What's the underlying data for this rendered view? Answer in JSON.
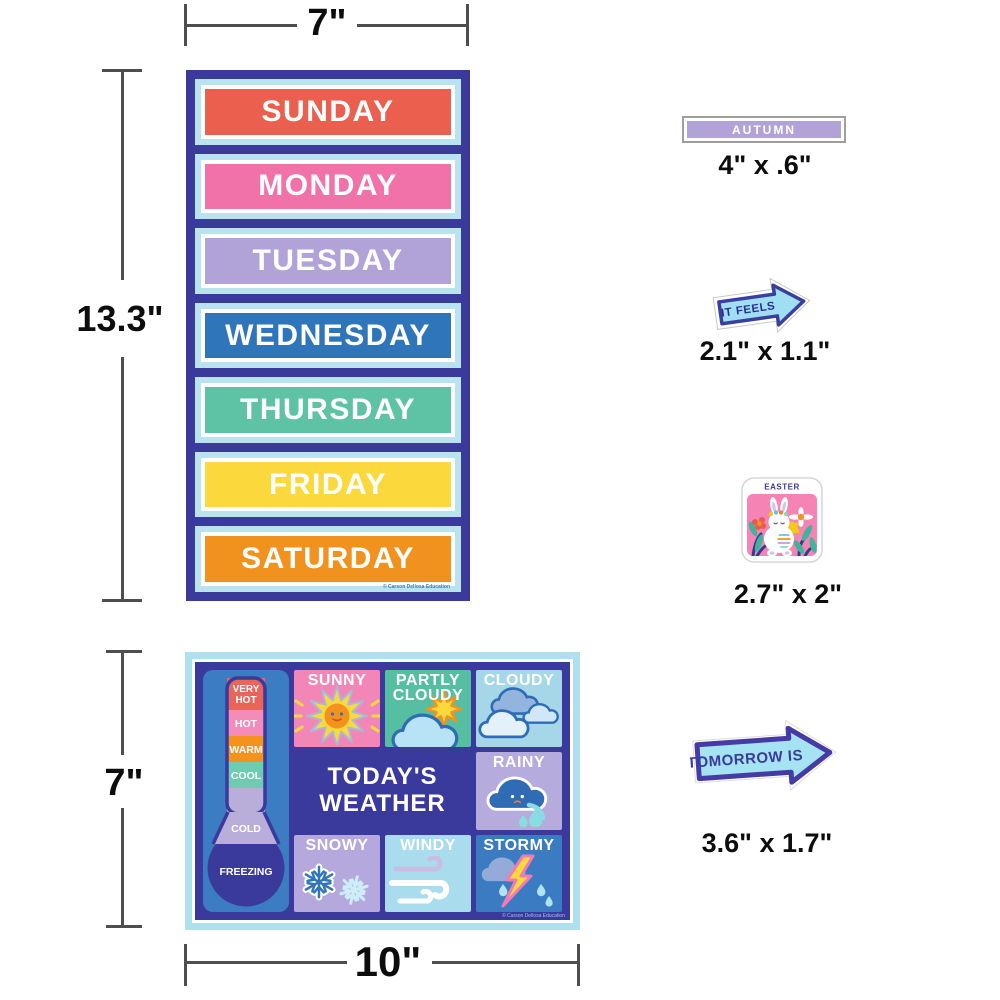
{
  "palette": {
    "navy": "#3a3a9c",
    "light_cyan": "#b9e4ef",
    "column_blue": "#3c7cc2",
    "dimension_line": "#4e4e4e"
  },
  "dimensions": {
    "days_width": "7\"",
    "days_height": "13.3\"",
    "weather_height": "7\"",
    "weather_width": "10\"",
    "autumn_size": "4\" x .6\"",
    "it_feels_size": "2.1\" x 1.1\"",
    "easter_size": "2.7\" x 2\"",
    "tomorrow_size": "3.6\" x 1.7\""
  },
  "days_chart": {
    "days": [
      {
        "label": "SUNDAY",
        "color": "#ea5f4e"
      },
      {
        "label": "MONDAY",
        "color": "#f172a9"
      },
      {
        "label": "TUESDAY",
        "color": "#b1a3d8"
      },
      {
        "label": "WEDNESDAY",
        "color": "#2f75ba"
      },
      {
        "label": "THURSDAY",
        "color": "#5ec3a4"
      },
      {
        "label": "FRIDAY",
        "color": "#fbd93d"
      },
      {
        "label": "SATURDAY",
        "color": "#f1911e"
      }
    ],
    "copyright": "© Carson Dellosa Education"
  },
  "weather_chart": {
    "title": "TODAY'S WEATHER",
    "title_lines": [
      "TODAY'S",
      "WEATHER"
    ],
    "thermometer": {
      "segments": [
        {
          "label": "VERY HOT",
          "lines": [
            "VERY",
            "HOT"
          ],
          "color": "#e9655a"
        },
        {
          "label": "HOT",
          "color": "#f48cba"
        },
        {
          "label": "WARM",
          "color": "#f5921e"
        },
        {
          "label": "COOL",
          "color": "#6fcbb2"
        },
        {
          "label": "COLD",
          "color": "#b9aed9"
        }
      ],
      "bulb": {
        "label": "FREEZING",
        "color": "#3a3a9c"
      }
    },
    "cells": {
      "sunny": {
        "label": "SUNNY",
        "bg": "#f287b7"
      },
      "partly": {
        "label": "PARTLY CLOUDY",
        "lines": [
          "PARTLY",
          "CLOUDY"
        ],
        "bg": "#56bfa2"
      },
      "cloudy": {
        "label": "CLOUDY",
        "bg": "#a6d7e8"
      },
      "rainy": {
        "label": "RAINY",
        "bg": "#b5abdc"
      },
      "snowy": {
        "label": "SNOWY",
        "bg": "#b4a8dc"
      },
      "windy": {
        "label": "WINDY",
        "bg": "#a9dcec"
      },
      "stormy": {
        "label": "STORMY",
        "bg": "#3b7bc1"
      }
    },
    "copyright": "© Carson Dellosa Education"
  },
  "stickers": {
    "autumn": {
      "label": "AUTUMN",
      "color": "#b1a3d8"
    },
    "it_feels": {
      "label": "IT FEELS",
      "fill": "#9fdff1",
      "border": "#3a3f9e"
    },
    "easter": {
      "label": "EASTER"
    },
    "tomorrow": {
      "label": "TOMORROW IS",
      "fill": "#a5e2f2",
      "border": "#463aa4"
    }
  }
}
